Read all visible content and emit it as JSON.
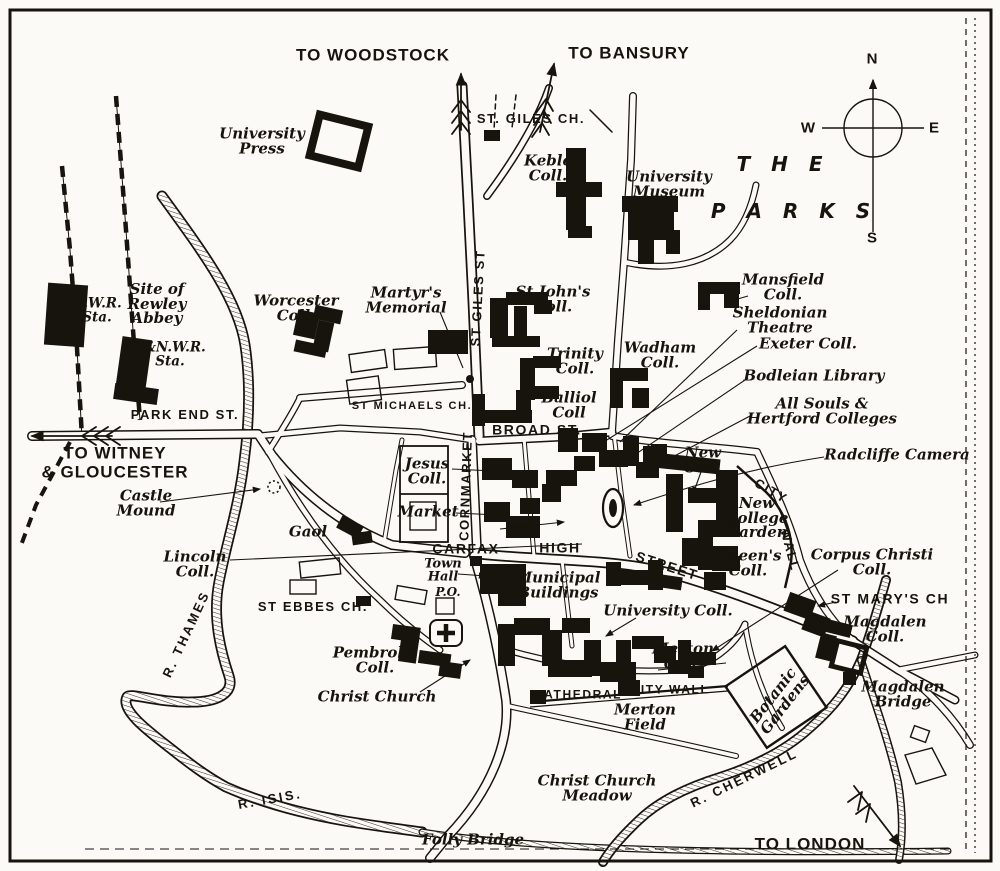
{
  "colors": {
    "paper": "#fbfaf6",
    "ink": "#17130d"
  },
  "map": {
    "labels": [
      {
        "name": "to-woodstock",
        "text": "TO WOODSTOCK",
        "x": 373,
        "y": 56,
        "cls": "route"
      },
      {
        "name": "to-bansury",
        "text": "TO BANSURY",
        "x": 629,
        "y": 54,
        "cls": "route"
      },
      {
        "name": "university-press",
        "text": "University\nPress",
        "x": 262,
        "y": 141,
        "cls": "ital"
      },
      {
        "name": "st-giles-church",
        "text": "ST. GILES CH.",
        "x": 531,
        "y": 119,
        "cls": "street",
        "size": 13
      },
      {
        "name": "keble-college",
        "text": "Keble\nColl.",
        "x": 548,
        "y": 168,
        "cls": "ital"
      },
      {
        "name": "university-museum",
        "text": "University\nMuseum",
        "x": 669,
        "y": 184,
        "cls": "ital"
      },
      {
        "name": "the-parks-line1",
        "text": "T H E",
        "x": 783,
        "y": 164,
        "cls": "parks"
      },
      {
        "name": "the-parks-line2",
        "text": "P A R K S",
        "x": 794,
        "y": 211,
        "cls": "parks"
      },
      {
        "name": "compass-n",
        "text": "N",
        "x": 872,
        "y": 59,
        "cls": "compass"
      },
      {
        "name": "compass-w",
        "text": "W",
        "x": 808,
        "y": 128,
        "cls": "compass"
      },
      {
        "name": "compass-e",
        "text": "E",
        "x": 934,
        "y": 128,
        "cls": "compass"
      },
      {
        "name": "compass-s",
        "text": "S",
        "x": 872,
        "y": 238,
        "cls": "compass"
      },
      {
        "name": "gwr-station",
        "text": "G.W.R.\nSta.",
        "x": 97,
        "y": 311,
        "cls": "station"
      },
      {
        "name": "rewley-abbey",
        "text": "Site of\nRewley\nAbbey",
        "x": 157,
        "y": 304,
        "cls": "ital"
      },
      {
        "name": "lnwr-station",
        "text": "L&N.W.R.\nSta.",
        "x": 170,
        "y": 355,
        "cls": "station"
      },
      {
        "name": "worcester-college",
        "text": "Worcester\nColl.",
        "x": 296,
        "y": 308,
        "cls": "ital"
      },
      {
        "name": "martyrs-memorial",
        "text": "Martyr's\nMemorial",
        "x": 406,
        "y": 300,
        "cls": "ital"
      },
      {
        "name": "st-giles-street",
        "text": "ST GILES ST",
        "x": 478,
        "y": 298,
        "cls": "street",
        "rot": -87,
        "size": 13
      },
      {
        "name": "st-johns-college",
        "text": "St John's\nColl.",
        "x": 553,
        "y": 299,
        "cls": "ital"
      },
      {
        "name": "trinity-college",
        "text": "Trinity\nColl.",
        "x": 575,
        "y": 361,
        "cls": "ital"
      },
      {
        "name": "balliol-college",
        "text": "Balliol\nColl",
        "x": 569,
        "y": 405,
        "cls": "ital"
      },
      {
        "name": "wadham-college",
        "text": "Wadham\nColl.",
        "x": 660,
        "y": 355,
        "cls": "ital"
      },
      {
        "name": "mansfield-college",
        "text": "Mansfield\nColl.",
        "x": 783,
        "y": 287,
        "cls": "ital"
      },
      {
        "name": "sheldonian-theatre",
        "text": "Sheldonian\nTheatre",
        "x": 780,
        "y": 320,
        "cls": "ital"
      },
      {
        "name": "exeter-college",
        "text": "Exeter Coll.",
        "x": 808,
        "y": 344,
        "cls": "ital"
      },
      {
        "name": "bodleian-library",
        "text": "Bodleian Library",
        "x": 814,
        "y": 376,
        "cls": "ital"
      },
      {
        "name": "all-souls-hertford",
        "text": "All Souls &\nHertford Colleges",
        "x": 822,
        "y": 411,
        "cls": "ital"
      },
      {
        "name": "radcliffe-camera",
        "text": "Radcliffe Camera",
        "x": 897,
        "y": 455,
        "cls": "ital"
      },
      {
        "name": "st-michaels-church",
        "text": "ST MICHAELS CH.",
        "x": 412,
        "y": 407,
        "cls": "street",
        "size": 11
      },
      {
        "name": "park-end-street",
        "text": "PARK END ST.",
        "x": 185,
        "y": 415,
        "cls": "street",
        "size": 13
      },
      {
        "name": "broad-street",
        "text": "BROAD ST.",
        "x": 537,
        "y": 430,
        "cls": "street"
      },
      {
        "name": "to-witney-gloucester",
        "text": "TO WITNEY\n& GLOUCESTER",
        "x": 115,
        "y": 463,
        "cls": "route"
      },
      {
        "name": "jesus-college",
        "text": "Jesus\nColl.",
        "x": 427,
        "y": 471,
        "cls": "ital"
      },
      {
        "name": "market",
        "text": "Market",
        "x": 428,
        "y": 512,
        "cls": "ital"
      },
      {
        "name": "cornmarket",
        "text": "CORNMARKET",
        "x": 466,
        "y": 486,
        "cls": "street",
        "rot": -88,
        "size": 13
      },
      {
        "name": "castle-mound",
        "text": "Castle\nMound",
        "x": 146,
        "y": 503,
        "cls": "ital"
      },
      {
        "name": "gaol",
        "text": "Gaol",
        "x": 308,
        "y": 532,
        "cls": "ital"
      },
      {
        "name": "lincoln-college",
        "text": "Lincoln\nColl.",
        "x": 195,
        "y": 564,
        "cls": "ital"
      },
      {
        "name": "carfax",
        "text": "CARFAX",
        "x": 466,
        "y": 549,
        "cls": "street"
      },
      {
        "name": "high",
        "text": "HIGH",
        "x": 560,
        "y": 548,
        "cls": "street"
      },
      {
        "name": "street",
        "text": "STREET",
        "x": 667,
        "y": 566,
        "cls": "street",
        "rot": 18
      },
      {
        "name": "new-college",
        "text": "New\nColl.",
        "x": 703,
        "y": 460,
        "cls": "ital"
      },
      {
        "name": "city-wall-ne-city",
        "text": "CITY",
        "x": 771,
        "y": 491,
        "cls": "street",
        "rot": 30,
        "size": 13
      },
      {
        "name": "city-wall-ne-wall",
        "text": "WALL",
        "x": 790,
        "y": 550,
        "cls": "street",
        "rot": 75,
        "size": 13
      },
      {
        "name": "new-college-garden",
        "text": "New\nCollege\nGarden",
        "x": 757,
        "y": 518,
        "cls": "ital"
      },
      {
        "name": "queens-college",
        "text": "Queen's\nColl.",
        "x": 748,
        "y": 563,
        "cls": "ital"
      },
      {
        "name": "corpus-christi-college",
        "text": "Corpus Christi\nColl.",
        "x": 872,
        "y": 562,
        "cls": "ital"
      },
      {
        "name": "st-marys-church",
        "text": "ST MARY'S CH",
        "x": 890,
        "y": 599,
        "cls": "street"
      },
      {
        "name": "magdalen-college",
        "text": "Magdalen\nColl.",
        "x": 885,
        "y": 629,
        "cls": "ital"
      },
      {
        "name": "university-college",
        "text": "University Coll.",
        "x": 668,
        "y": 611,
        "cls": "ital"
      },
      {
        "name": "town-hall",
        "text": "Town\nHall",
        "x": 443,
        "y": 571,
        "cls": "ital",
        "size": 13
      },
      {
        "name": "post-office",
        "text": "P.O.",
        "x": 448,
        "y": 593,
        "cls": "ital",
        "size": 12
      },
      {
        "name": "municipal-buildings",
        "text": "Municipal\nBuildings",
        "x": 558,
        "y": 585,
        "cls": "ital"
      },
      {
        "name": "st-ebbes-church",
        "text": "ST EBBES CH.",
        "x": 313,
        "y": 607,
        "cls": "street",
        "size": 13
      },
      {
        "name": "pembroke-college",
        "text": "Pembroke\nColl.",
        "x": 375,
        "y": 660,
        "cls": "ital"
      },
      {
        "name": "merton-college",
        "text": "Merton\nColl.",
        "x": 683,
        "y": 656,
        "cls": "ital"
      },
      {
        "name": "christ-church",
        "text": "Christ Church",
        "x": 377,
        "y": 697,
        "cls": "ital"
      },
      {
        "name": "cathedral",
        "text": "CATHEDRAL",
        "x": 578,
        "y": 695,
        "cls": "street",
        "size": 12
      },
      {
        "name": "city-wall-south",
        "text": "CITY WALL",
        "x": 670,
        "y": 690,
        "cls": "street",
        "size": 12
      },
      {
        "name": "merton-field",
        "text": "Merton\nField",
        "x": 645,
        "y": 717,
        "cls": "ital"
      },
      {
        "name": "botanic-gardens",
        "text": "Botanic\nGardens",
        "x": 779,
        "y": 700,
        "cls": "ital",
        "rot": -52
      },
      {
        "name": "magdalen-bridge",
        "text": "Magdalen\nBridge",
        "x": 903,
        "y": 694,
        "cls": "ital"
      },
      {
        "name": "river-thames",
        "text": "R. THAMES",
        "x": 186,
        "y": 634,
        "cls": "river",
        "rot": -65
      },
      {
        "name": "river-isis",
        "text": "R. ISIS.",
        "x": 270,
        "y": 799,
        "cls": "river",
        "rot": -10
      },
      {
        "name": "christ-church-meadow",
        "text": "Christ Church\nMeadow",
        "x": 597,
        "y": 788,
        "cls": "ital"
      },
      {
        "name": "folly-bridge",
        "text": "Folly Bridge",
        "x": 473,
        "y": 840,
        "cls": "ital"
      },
      {
        "name": "river-cherwell",
        "text": "R. CHERWELL",
        "x": 744,
        "y": 778,
        "cls": "river",
        "rot": -26
      },
      {
        "name": "to-london",
        "text": "TO LONDON",
        "x": 810,
        "y": 845,
        "cls": "route"
      }
    ]
  }
}
